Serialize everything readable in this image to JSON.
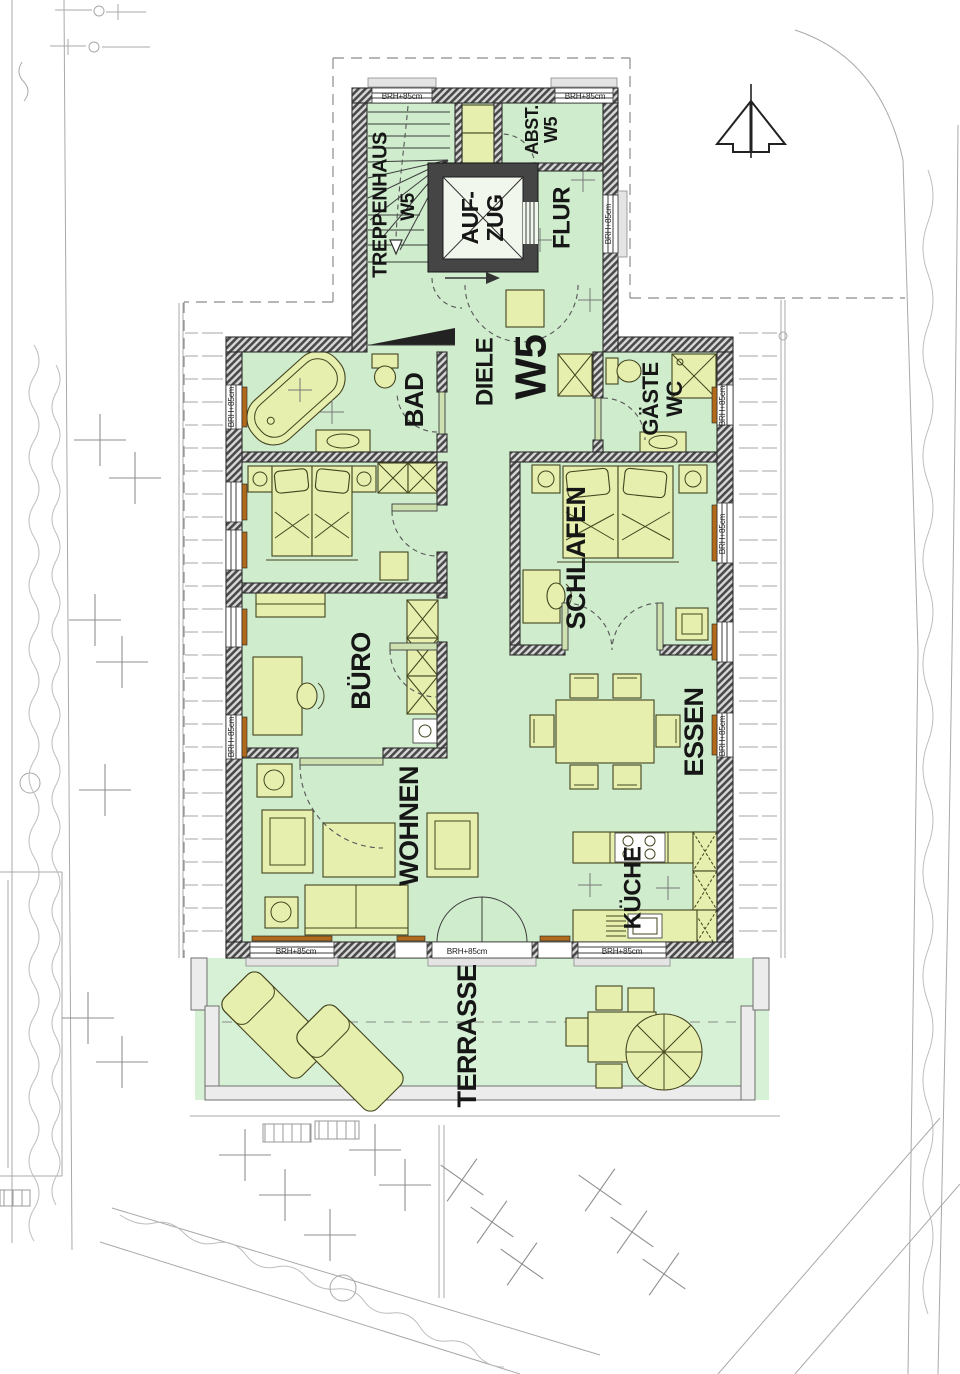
{
  "plan": {
    "rooms": {
      "treppenhaus": {
        "label": "TREPPENHAUS",
        "unit": "W5"
      },
      "aufzug": {
        "line1": "AUF-",
        "line2": "ZUG"
      },
      "abstellraum": {
        "line1": "ABST.",
        "line2": "W5"
      },
      "flur": {
        "label": "FLUR"
      },
      "diele": {
        "label": "DIELE",
        "unit": "W5"
      },
      "bad": {
        "label": "BAD"
      },
      "gaeste_wc": {
        "line1": "GÄSTE",
        "line2": "WC"
      },
      "schlafen": {
        "label": "SCHLAFEN"
      },
      "buero": {
        "label": "BÜRO"
      },
      "wohnen": {
        "label": "WOHNEN"
      },
      "essen": {
        "label": "ESSEN"
      },
      "kueche": {
        "label": "KÜCHE"
      },
      "terrasse": {
        "label": "TERRASSE"
      }
    },
    "annotations": {
      "sill_height": "BRH+85cm"
    },
    "icons": {
      "north_arrow": "north-arrow-icon",
      "stair_direction": "stair-down-arrow-icon",
      "entry_direction": "entry-arrow-icon"
    },
    "colors": {
      "floor": "#cfeccd",
      "terrace_floor": "#d7f1d6",
      "furniture": "#e6efad",
      "sill": "#b06a1c"
    }
  }
}
